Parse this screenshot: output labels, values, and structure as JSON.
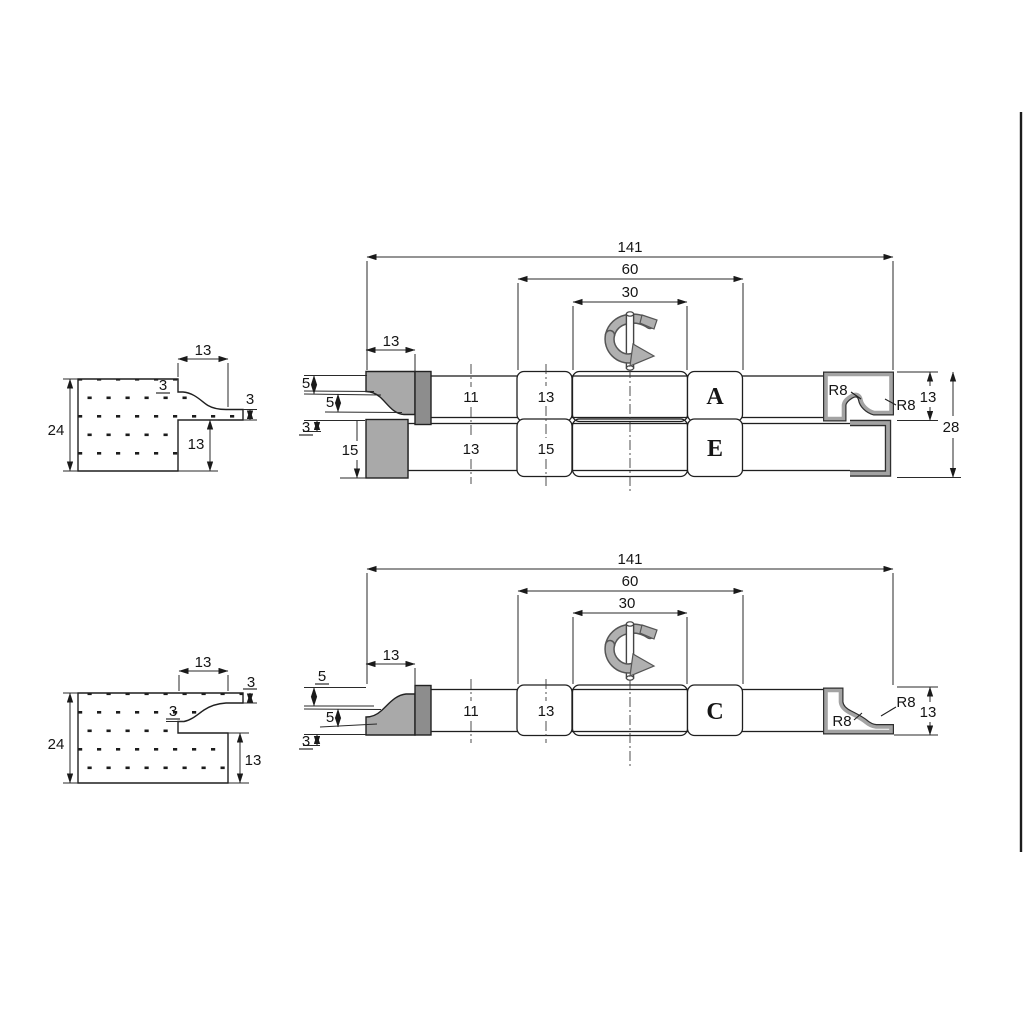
{
  "colors": {
    "line": "#1f1f1f",
    "cutter_fill": "#a9a9a9",
    "cutter_dark_fill": "#8d8d8d",
    "profile_band": "#a3a3a3",
    "profile_edge": "#2f2f2f",
    "arrow_gray": "#b0b0b0",
    "arrow_edge": "#555555"
  },
  "top_section": {
    "h24": "24",
    "w13": "13",
    "step3": "3",
    "tongue3": "3",
    "h13": "13"
  },
  "top_assembly": {
    "len141": "141",
    "len60": "60",
    "len30": "30",
    "cutter13": "13",
    "dim5a": "5",
    "dim5b": "5",
    "dim3": "3",
    "block15": "15",
    "bar11": "11",
    "spacer13": "13",
    "bar13": "13",
    "spacer15": "15",
    "head_a": "A",
    "head_e": "E",
    "r8a": "R8",
    "r8b": "R8",
    "h13": "13",
    "h28": "28"
  },
  "bottom_section": {
    "h24": "24",
    "w13": "13",
    "tongue3": "3",
    "step3": "3",
    "h13": "13"
  },
  "bottom_assembly": {
    "len141": "141",
    "len60": "60",
    "len30": "30",
    "cutter13": "13",
    "dim5a": "5",
    "dim5b": "5",
    "dim3": "3",
    "bar11": "11",
    "spacer13": "13",
    "head_c": "C",
    "r8a": "R8",
    "r8b": "R8",
    "h13": "13"
  }
}
